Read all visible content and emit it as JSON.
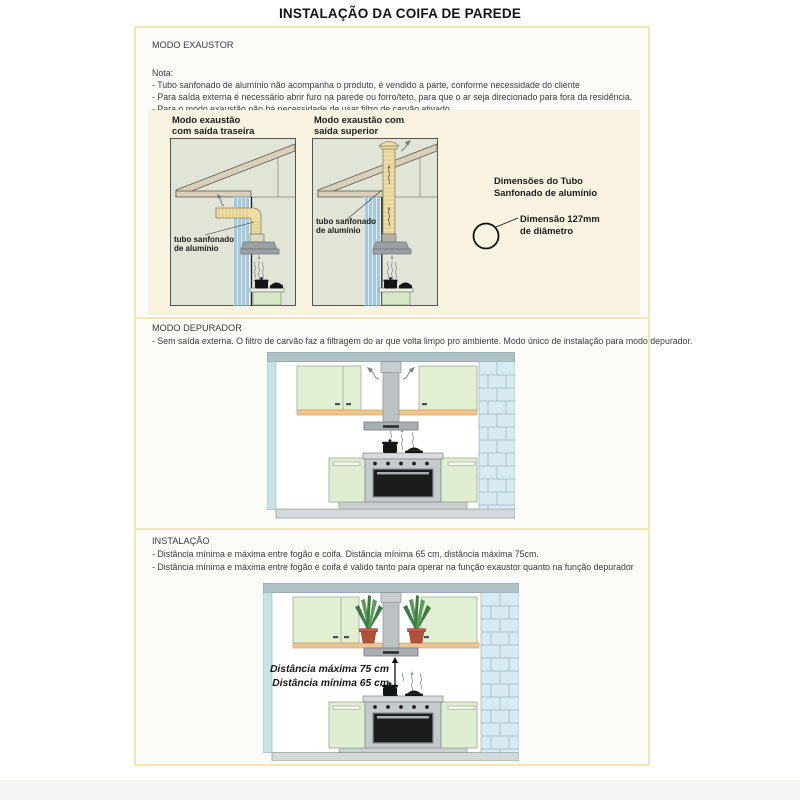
{
  "page": {
    "title": "INSTALAÇÃO DA COIFA DE PAREDE"
  },
  "exaustor": {
    "heading": "MODO EXAUSTOR",
    "nota_label": "Nota:",
    "notes": [
      "- Tubo sanfonado de alumínio não acompanha o produto, é vendido a parte, conforme necessidade do cliente",
      "- Para saída externa é necessário abrir furo na parede ou forro/teto, para que o ar seja direcionado para fora da residência.",
      "- Para o modo exaustão não há necessidade de usar filtro de carvão ativado."
    ],
    "rear": {
      "title_l1": "Modo exaustão",
      "title_l2": "com saída traseira",
      "tube_label_l1": "tubo sanfonado",
      "tube_label_l2": "de alumínio"
    },
    "top": {
      "title_l1": "Modo exaustão com",
      "title_l2": "saída superior",
      "tube_label_l1": "tubo sanfonado",
      "tube_label_l2": "de alumínio"
    },
    "dims": {
      "heading_l1": "Dimensões do Tubo",
      "heading_l2": "Sanfonado de alumínio",
      "label_l1": "Dimensão 127mm",
      "label_l2": "de diâmetro"
    }
  },
  "depurador": {
    "heading": "MODO DEPURADOR",
    "note": "- Sem saída externa. O filtro de carvão faz a filtragem do ar que volta limpo pro ambiente. Modo único de instalação para modo depurador."
  },
  "instalacao": {
    "heading": "INSTALAÇÃO",
    "notes": [
      "- Distância mínima e máxima entre fogão e coifa. Distância mínima 65 cm, distância máxima 75cm.",
      "- Distância mínima e máxima entre fogão e coifa é valido tanto para operar na função exaustor quanto na função depurador"
    ],
    "dist_max": "Distância máxima 75 cm",
    "dist_min": "Distância mínima 65 cm"
  },
  "colors": {
    "accent_border": "#f1e7b6",
    "panel_bg": "#f8f3e1",
    "diagram_bg": "#e1e5d8",
    "roof_tan": "#d8d0bb",
    "tube_tan": "#efdda6",
    "wall_stripe_blue": "#a9cde1",
    "cabinet_green": "#e3efd3",
    "shelf_orange": "#ecc592",
    "brick_blue": "#d8ebf5",
    "steel_gray": "#bcc1c4"
  }
}
